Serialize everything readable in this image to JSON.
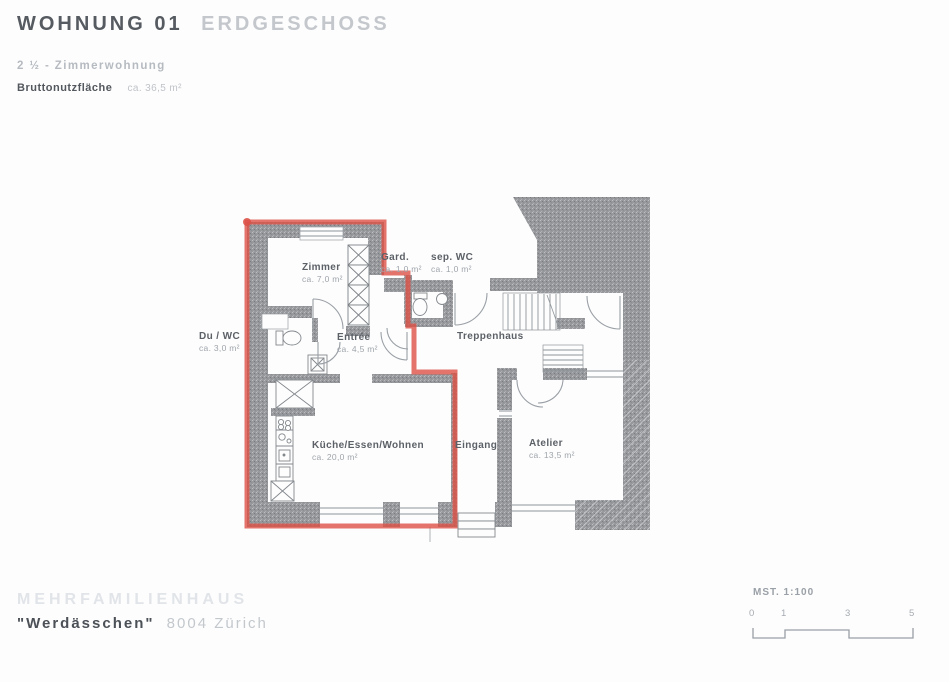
{
  "header": {
    "title": "WOHNUNG 01",
    "title_secondary": "ERDGESCHOSS",
    "subtitle": "2 ½ - Zimmerwohnung",
    "area_label": "Bruttonutzfläche",
    "area_value": "ca. 36,5 m²"
  },
  "plan": {
    "highlight_color": "#dc5046",
    "wall_color": "#97999d",
    "rooms": [
      {
        "name": "Zimmer",
        "area": "ca. 7,0 m²"
      },
      {
        "name": "Gard.",
        "area": "ca. 1,0 m²"
      },
      {
        "name": "sep. WC",
        "area": "ca. 1,0 m²"
      },
      {
        "name": "Du / WC",
        "area": "ca. 3,0 m²"
      },
      {
        "name": "Entrée",
        "area": "ca. 4,5 m²"
      },
      {
        "name": "Treppenhaus",
        "area": ""
      },
      {
        "name": "Küche/Essen/Wohnen",
        "area": "ca. 20,0 m²"
      },
      {
        "name": "Eingang",
        "area": ""
      },
      {
        "name": "Atelier",
        "area": "ca. 13,5 m²"
      }
    ]
  },
  "footer": {
    "project": "MEHRFAMILIENHAUS",
    "building_name": "\"Werdässchen\"",
    "location": "8004 Zürich"
  },
  "scale": {
    "label": "MST. 1:100",
    "ticks": [
      "0",
      "1",
      "3",
      "5"
    ]
  }
}
